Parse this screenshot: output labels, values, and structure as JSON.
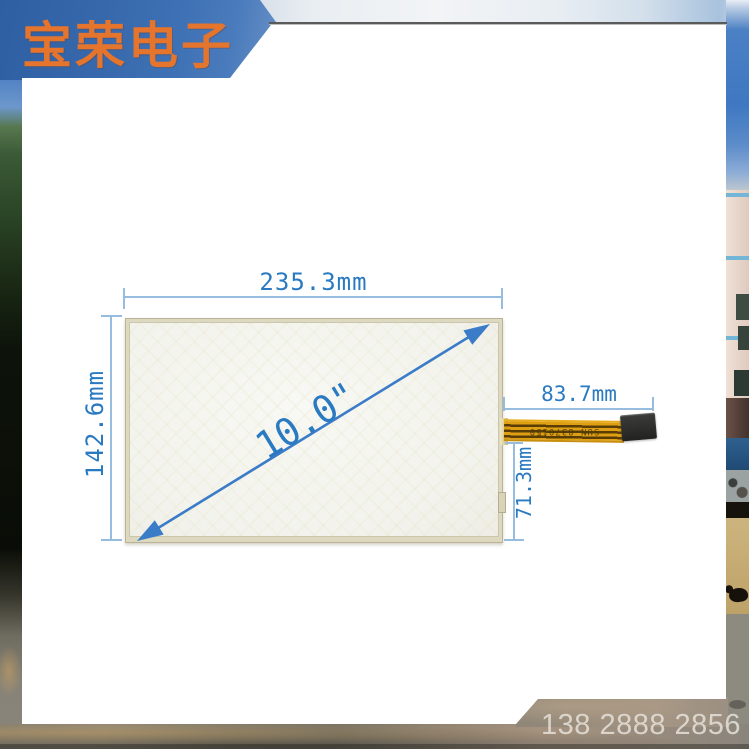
{
  "banner": {
    "brand": "宝荣电子"
  },
  "product": {
    "name": "10.0 inch resistive touch screen panel",
    "annotations": {
      "width": "235.3mm",
      "height": "142.6mm",
      "diagonal": "10.0\"",
      "cable_length": "83.7mm",
      "cable_offset": "71.3mm"
    },
    "cable_marking": "SUN-8370150"
  },
  "footer": {
    "phone": "138 2888 2856"
  },
  "colors": {
    "banner_blue": "#3d70b4",
    "brand_orange": "#e5742d",
    "dimension_text_blue": "#2a7ac2",
    "dimension_line_blue": "#96bcdf",
    "arrow_blue": "#3b7cc8",
    "cable_gold": "#df9f12",
    "panel_frame_beige": "#ddd8c0",
    "phone_gray": "#e5e1d9"
  }
}
